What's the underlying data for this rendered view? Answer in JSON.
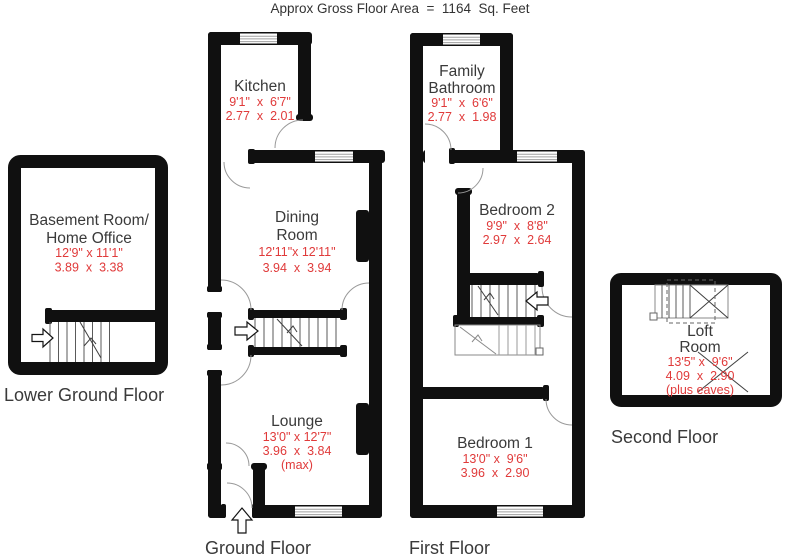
{
  "title": "Approx Gross Floor Area  =  1164  Sq. Feet",
  "colors": {
    "wall": "#101010",
    "dimension_text": "#e03a3a",
    "room_text": "#3a3a3a"
  },
  "floors": {
    "lower_ground": {
      "label": "Lower Ground Floor",
      "basement": {
        "line1": "Basement Room/",
        "line2": "Home Office",
        "imperial": "12'9\" x 11'1\"",
        "metric": "3.89  x  3.38"
      }
    },
    "ground": {
      "label": "Ground Floor",
      "kitchen": {
        "name": "Kitchen",
        "imperial": "9'1\"  x  6'7\"",
        "metric": "2.77  x  2.01"
      },
      "dining": {
        "line1": "Dining",
        "line2": "Room",
        "imperial": "12'11\"x 12'11\"",
        "metric": "3.94  x  3.94"
      },
      "lounge": {
        "name": "Lounge",
        "imperial": "13'0\" x 12'7\"",
        "metric": "3.96  x  3.84",
        "note": "(max)"
      }
    },
    "first": {
      "label": "First Floor",
      "bathroom": {
        "line1": "Family",
        "line2": "Bathroom",
        "imperial": "9'1\"  x  6'6\"",
        "metric": "2.77  x  1.98"
      },
      "bedroom2": {
        "name": "Bedroom 2",
        "imperial": "9'9\"  x  8'8\"",
        "metric": "2.97  x  2.64"
      },
      "bedroom1": {
        "name": "Bedroom 1",
        "imperial": "13'0\" x  9'6\"",
        "metric": "3.96  x  2.90"
      }
    },
    "second": {
      "label": "Second Floor",
      "loft": {
        "line1": "Loft",
        "line2": "Room",
        "imperial": "13'5\" x  9'6\"",
        "metric": "4.09  x  2.90",
        "note": "(plus eaves)"
      }
    }
  }
}
